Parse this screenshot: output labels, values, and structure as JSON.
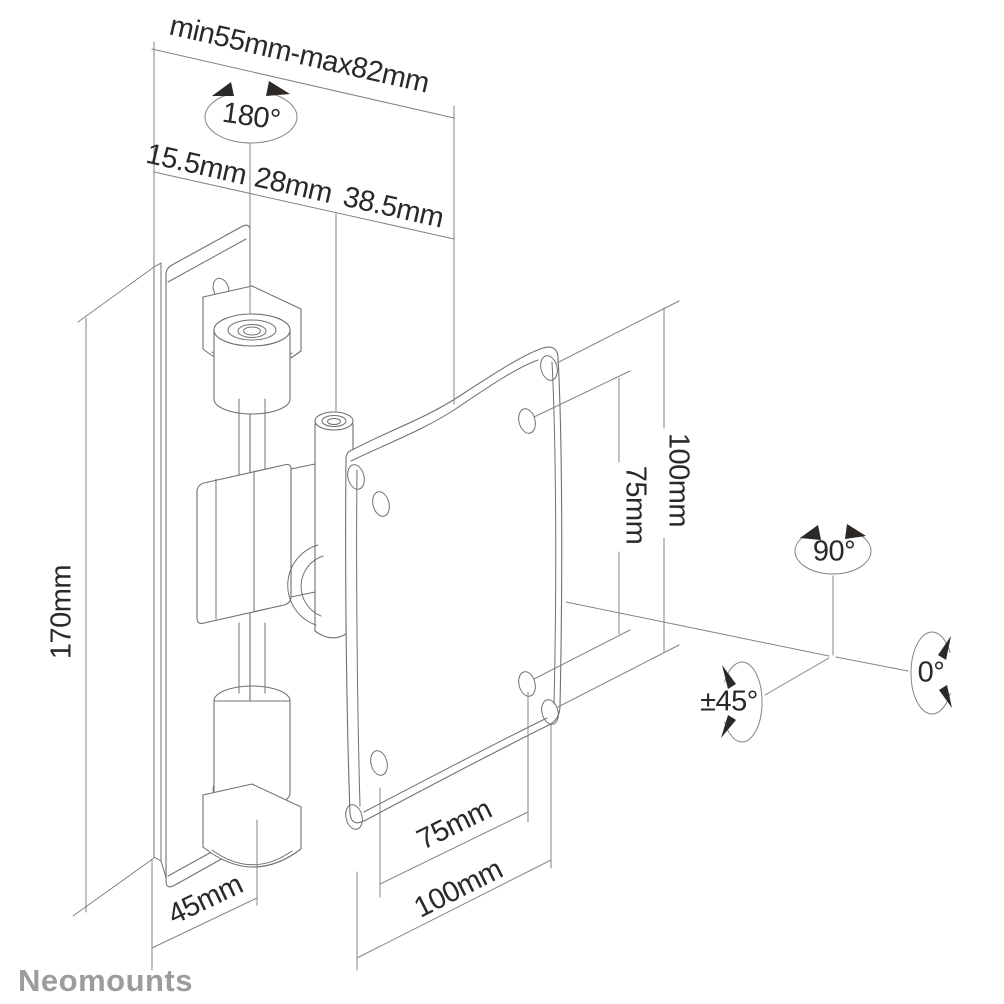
{
  "colors": {
    "background": "#ffffff",
    "object_line": "#6f7073",
    "dimension_line": "#838487",
    "text": "#2b2826",
    "brand": "#9c9c9b"
  },
  "brand": {
    "name": "Neomounts"
  },
  "dimensions": {
    "top": {
      "range": "min55mm-max82mm",
      "swivel": "180°",
      "segments": [
        "15.5mm",
        "28mm",
        "38.5mm"
      ]
    },
    "left": {
      "plate_height": "170mm"
    },
    "vesa_right": {
      "outer": "100mm",
      "inner": "75mm"
    },
    "bottom": {
      "wall_plate": "45mm",
      "vesa_inner": "75mm",
      "vesa_outer": "100mm"
    },
    "rotation": {
      "pan": "90°",
      "roll": "0°",
      "tilt": "±45°"
    }
  }
}
